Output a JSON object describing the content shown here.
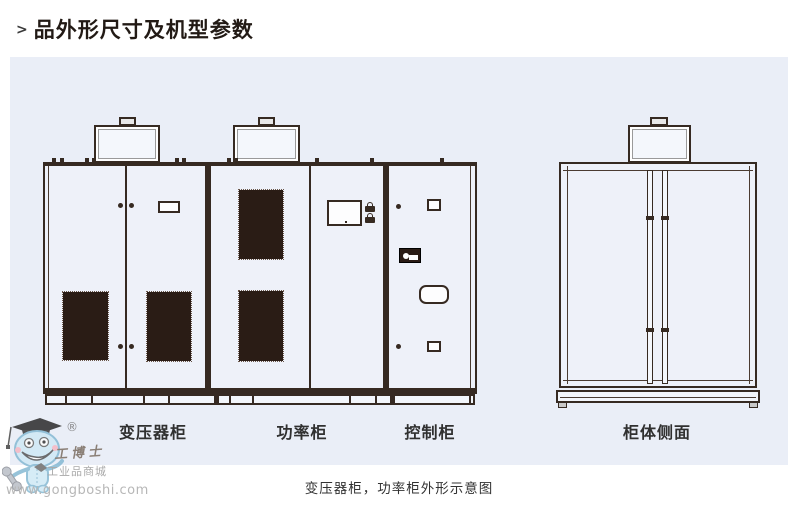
{
  "page": {
    "title_arrow": ">",
    "title": "品外形尺寸及机型参数",
    "caption": "变压器柜，功率柜外形示意图"
  },
  "diagram": {
    "labels": {
      "transformer": "变压器柜",
      "power": "功率柜",
      "control": "控制柜",
      "side": "柜体侧面"
    },
    "views": [
      "front-lineup",
      "side-view"
    ],
    "front_sections": [
      "变压器柜",
      "功率柜",
      "控制柜"
    ]
  },
  "watermark": {
    "registered": "®",
    "brand": "工博士",
    "tagline": "工业品商城",
    "url": "www.gongboshi.com"
  },
  "colors": {
    "panel_bg": "#eaeef7",
    "line_ink": "#362a22",
    "vent_fill": "#2a1c15",
    "title_color": "#221a15",
    "label_color": "#303030",
    "watermark_gray": "#9b9b9b",
    "mascot_blue": "#cfe9f5"
  }
}
